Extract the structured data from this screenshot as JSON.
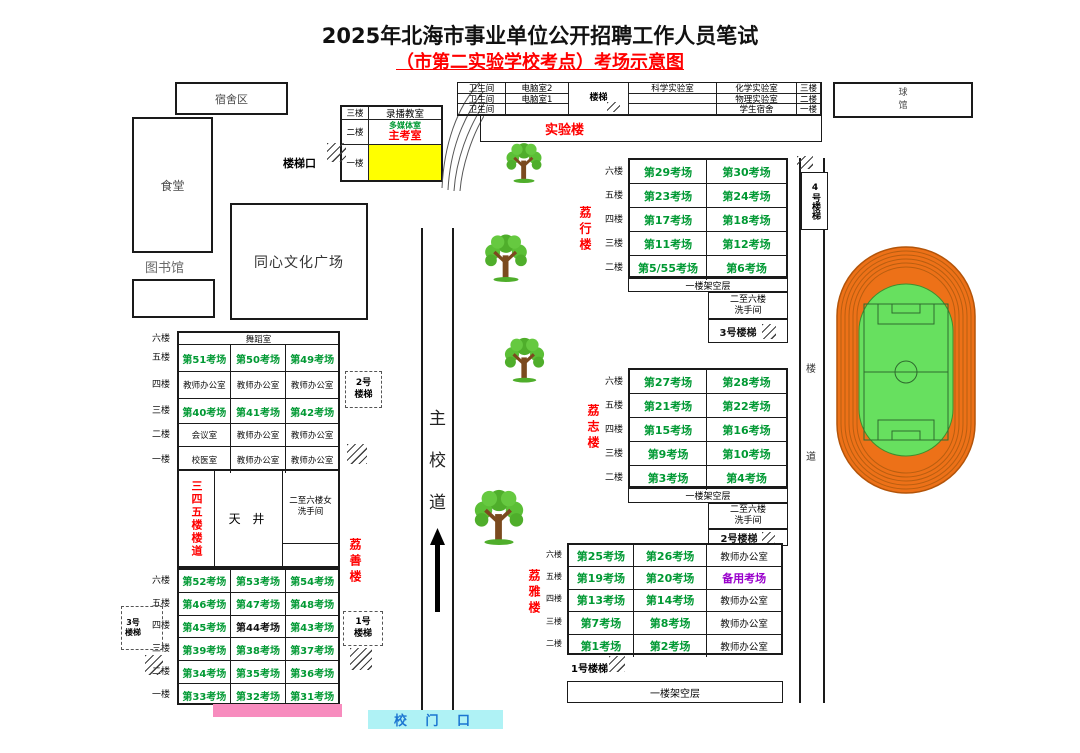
{
  "title": {
    "line1": "2025年北海市事业单位公开招聘工作人员笔试",
    "line2": "（市第二实验学校考点）考场示意图"
  },
  "colors": {
    "room_green": "#009933",
    "label_red": "#FF0000",
    "backup_purple": "#9900CC",
    "chief_room_yellow": "#FFFF00",
    "gate_cyan": "#AFF2F5",
    "gate_text_blue": "#1B75D1",
    "pink_bar": "#F78CBE",
    "track_orange": "#ED7118",
    "field_green": "#67E05F"
  },
  "places": {
    "dorm_area": "宿舍区",
    "canteen": "食堂",
    "library": "图书馆",
    "plaza": "同心文化广场",
    "ball_hall": "球馆",
    "stair_entrance": "楼梯口",
    "main_road": [
      "主",
      "校",
      "道"
    ],
    "school_gate": "校 门 口"
  },
  "recording_building": {
    "floor3": "三楼",
    "room3": "录播教室",
    "floor2": "二楼",
    "room2a": "多媒体室",
    "room2b": "主考室",
    "floor1": "一楼"
  },
  "lab_building": {
    "name": "实验楼",
    "stair": "楼梯",
    "rows": [
      {
        "floor": "三楼",
        "c1": "卫生间",
        "c2": "电脑室2",
        "c3": "科学实验室",
        "c4": "化学实验室"
      },
      {
        "floor": "二楼",
        "c1": "卫生间",
        "c2": "电脑室1",
        "c3": "",
        "c4": "物理实验室"
      },
      {
        "floor": "一楼",
        "c1": "卫生间",
        "c2": "",
        "c3": "",
        "c4": "学生宿舍"
      }
    ]
  },
  "lixing": {
    "name": "荔行楼",
    "rows": [
      {
        "floor": "六楼",
        "cells": [
          {
            "t": "第29考场",
            "c": "g"
          },
          {
            "t": "第30考场",
            "c": "g"
          }
        ]
      },
      {
        "floor": "五楼",
        "cells": [
          {
            "t": "第23考场",
            "c": "g"
          },
          {
            "t": "第24考场",
            "c": "g"
          }
        ]
      },
      {
        "floor": "四楼",
        "cells": [
          {
            "t": "第17考场",
            "c": "g"
          },
          {
            "t": "第18考场",
            "c": "g"
          }
        ]
      },
      {
        "floor": "三楼",
        "cells": [
          {
            "t": "第11考场",
            "c": "g"
          },
          {
            "t": "第12考场",
            "c": "g"
          }
        ]
      },
      {
        "floor": "二楼",
        "cells": [
          {
            "t": "第5/55考场",
            "c": "g"
          },
          {
            "t": "第6考场",
            "c": "g"
          }
        ]
      }
    ],
    "ground": "一楼架空层",
    "washroom": [
      "二至六楼",
      "洗手间"
    ],
    "stair3": "3号楼梯",
    "stair4": "4号楼梯"
  },
  "lizhi": {
    "name": "荔志楼",
    "rows": [
      {
        "floor": "六楼",
        "cells": [
          {
            "t": "第27考场",
            "c": "g"
          },
          {
            "t": "第28考场",
            "c": "g"
          }
        ]
      },
      {
        "floor": "五楼",
        "cells": [
          {
            "t": "第21考场",
            "c": "g"
          },
          {
            "t": "第22考场",
            "c": "g"
          }
        ]
      },
      {
        "floor": "四楼",
        "cells": [
          {
            "t": "第15考场",
            "c": "g"
          },
          {
            "t": "第16考场",
            "c": "g"
          }
        ]
      },
      {
        "floor": "三楼",
        "cells": [
          {
            "t": "第9考场",
            "c": "g"
          },
          {
            "t": "第10考场",
            "c": "g"
          }
        ]
      },
      {
        "floor": "二楼",
        "cells": [
          {
            "t": "第3考场",
            "c": "g"
          },
          {
            "t": "第4考场",
            "c": "g"
          }
        ]
      }
    ],
    "ground": "一楼架空层",
    "washroom": [
      "二至六楼",
      "洗手间"
    ],
    "stair2": "2号楼梯",
    "corridor_chars": [
      "楼",
      "道"
    ]
  },
  "liya": {
    "name": "荔雅楼",
    "rows": [
      {
        "floor": "六楼",
        "cells": [
          {
            "t": "第25考场",
            "c": "g"
          },
          {
            "t": "第26考场",
            "c": "g"
          },
          {
            "t": "教师办公室",
            "c": "k"
          }
        ]
      },
      {
        "floor": "五楼",
        "cells": [
          {
            "t": "第19考场",
            "c": "g"
          },
          {
            "t": "第20考场",
            "c": "g"
          },
          {
            "t": "备用考场",
            "c": "p"
          }
        ]
      },
      {
        "floor": "四楼",
        "cells": [
          {
            "t": "第13考场",
            "c": "g"
          },
          {
            "t": "第14考场",
            "c": "g"
          },
          {
            "t": "教师办公室",
            "c": "k"
          }
        ]
      },
      {
        "floor": "三楼",
        "cells": [
          {
            "t": "第7考场",
            "c": "g"
          },
          {
            "t": "第8考场",
            "c": "g"
          },
          {
            "t": "教师办公室",
            "c": "k"
          }
        ]
      },
      {
        "floor": "二楼",
        "cells": [
          {
            "t": "第1考场",
            "c": "g"
          },
          {
            "t": "第2考场",
            "c": "g"
          },
          {
            "t": "教师办公室",
            "c": "k"
          }
        ]
      }
    ],
    "stair1": "1号楼梯",
    "ground": "一楼架空层"
  },
  "lishan": {
    "name": "荔善楼",
    "upper_rows": [
      {
        "floor": "六楼",
        "cells": [
          {
            "t": "舞蹈室",
            "c": "k",
            "span": true
          }
        ]
      },
      {
        "floor": "五楼",
        "cells": [
          {
            "t": "第51考场",
            "c": "g"
          },
          {
            "t": "第50考场",
            "c": "g"
          },
          {
            "t": "第49考场",
            "c": "g"
          }
        ]
      },
      {
        "floor": "四楼",
        "cells": [
          {
            "t": "教师办公室",
            "c": "k"
          },
          {
            "t": "教师办公室",
            "c": "k"
          },
          {
            "t": "教师办公室",
            "c": "k"
          }
        ]
      },
      {
        "floor": "三楼",
        "cells": [
          {
            "t": "第40考场",
            "c": "g"
          },
          {
            "t": "第41考场",
            "c": "g"
          },
          {
            "t": "第42考场",
            "c": "g"
          }
        ]
      },
      {
        "floor": "二楼",
        "cells": [
          {
            "t": "会议室",
            "c": "k"
          },
          {
            "t": "教师办公室",
            "c": "k"
          },
          {
            "t": "教师办公室",
            "c": "k"
          }
        ]
      },
      {
        "floor": "一楼",
        "cells": [
          {
            "t": "校医室",
            "c": "k"
          },
          {
            "t": "教师办公室",
            "c": "k"
          },
          {
            "t": "教师办公室",
            "c": "k"
          }
        ]
      }
    ],
    "corridor_vertical": "三四五楼楼道",
    "courtyard": "天 井",
    "washroom_f": [
      "二至六楼女",
      "洗手间"
    ],
    "lower_rows": [
      {
        "floor": "六楼",
        "cells": [
          {
            "t": "第52考场",
            "c": "g"
          },
          {
            "t": "第53考场",
            "c": "g"
          },
          {
            "t": "第54考场",
            "c": "g"
          }
        ]
      },
      {
        "floor": "五楼",
        "cells": [
          {
            "t": "第46考场",
            "c": "g"
          },
          {
            "t": "第47考场",
            "c": "g"
          },
          {
            "t": "第48考场",
            "c": "g"
          }
        ]
      },
      {
        "floor": "四楼",
        "cells": [
          {
            "t": "第45考场",
            "c": "g"
          },
          {
            "t": "第44考场",
            "c": "kb"
          },
          {
            "t": "第43考场",
            "c": "g"
          }
        ]
      },
      {
        "floor": "三楼",
        "cells": [
          {
            "t": "第39考场",
            "c": "g"
          },
          {
            "t": "第38考场",
            "c": "g"
          },
          {
            "t": "第37考场",
            "c": "g"
          }
        ]
      },
      {
        "floor": "二楼",
        "cells": [
          {
            "t": "第34考场",
            "c": "g"
          },
          {
            "t": "第35考场",
            "c": "g"
          },
          {
            "t": "第36考场",
            "c": "g"
          }
        ]
      },
      {
        "floor": "一楼",
        "cells": [
          {
            "t": "第33考场",
            "c": "g"
          },
          {
            "t": "第32考场",
            "c": "g"
          },
          {
            "t": "第31考场",
            "c": "g"
          }
        ]
      }
    ],
    "stair1": "1号楼梯",
    "stair2": "2号楼梯",
    "stair3": "3号楼梯"
  },
  "icons": {
    "tree": "tree-icon",
    "up_arrow": "up-arrow-icon",
    "stairs_hatch": "stairs-hatch-icon",
    "sports_field": "sports-field"
  }
}
